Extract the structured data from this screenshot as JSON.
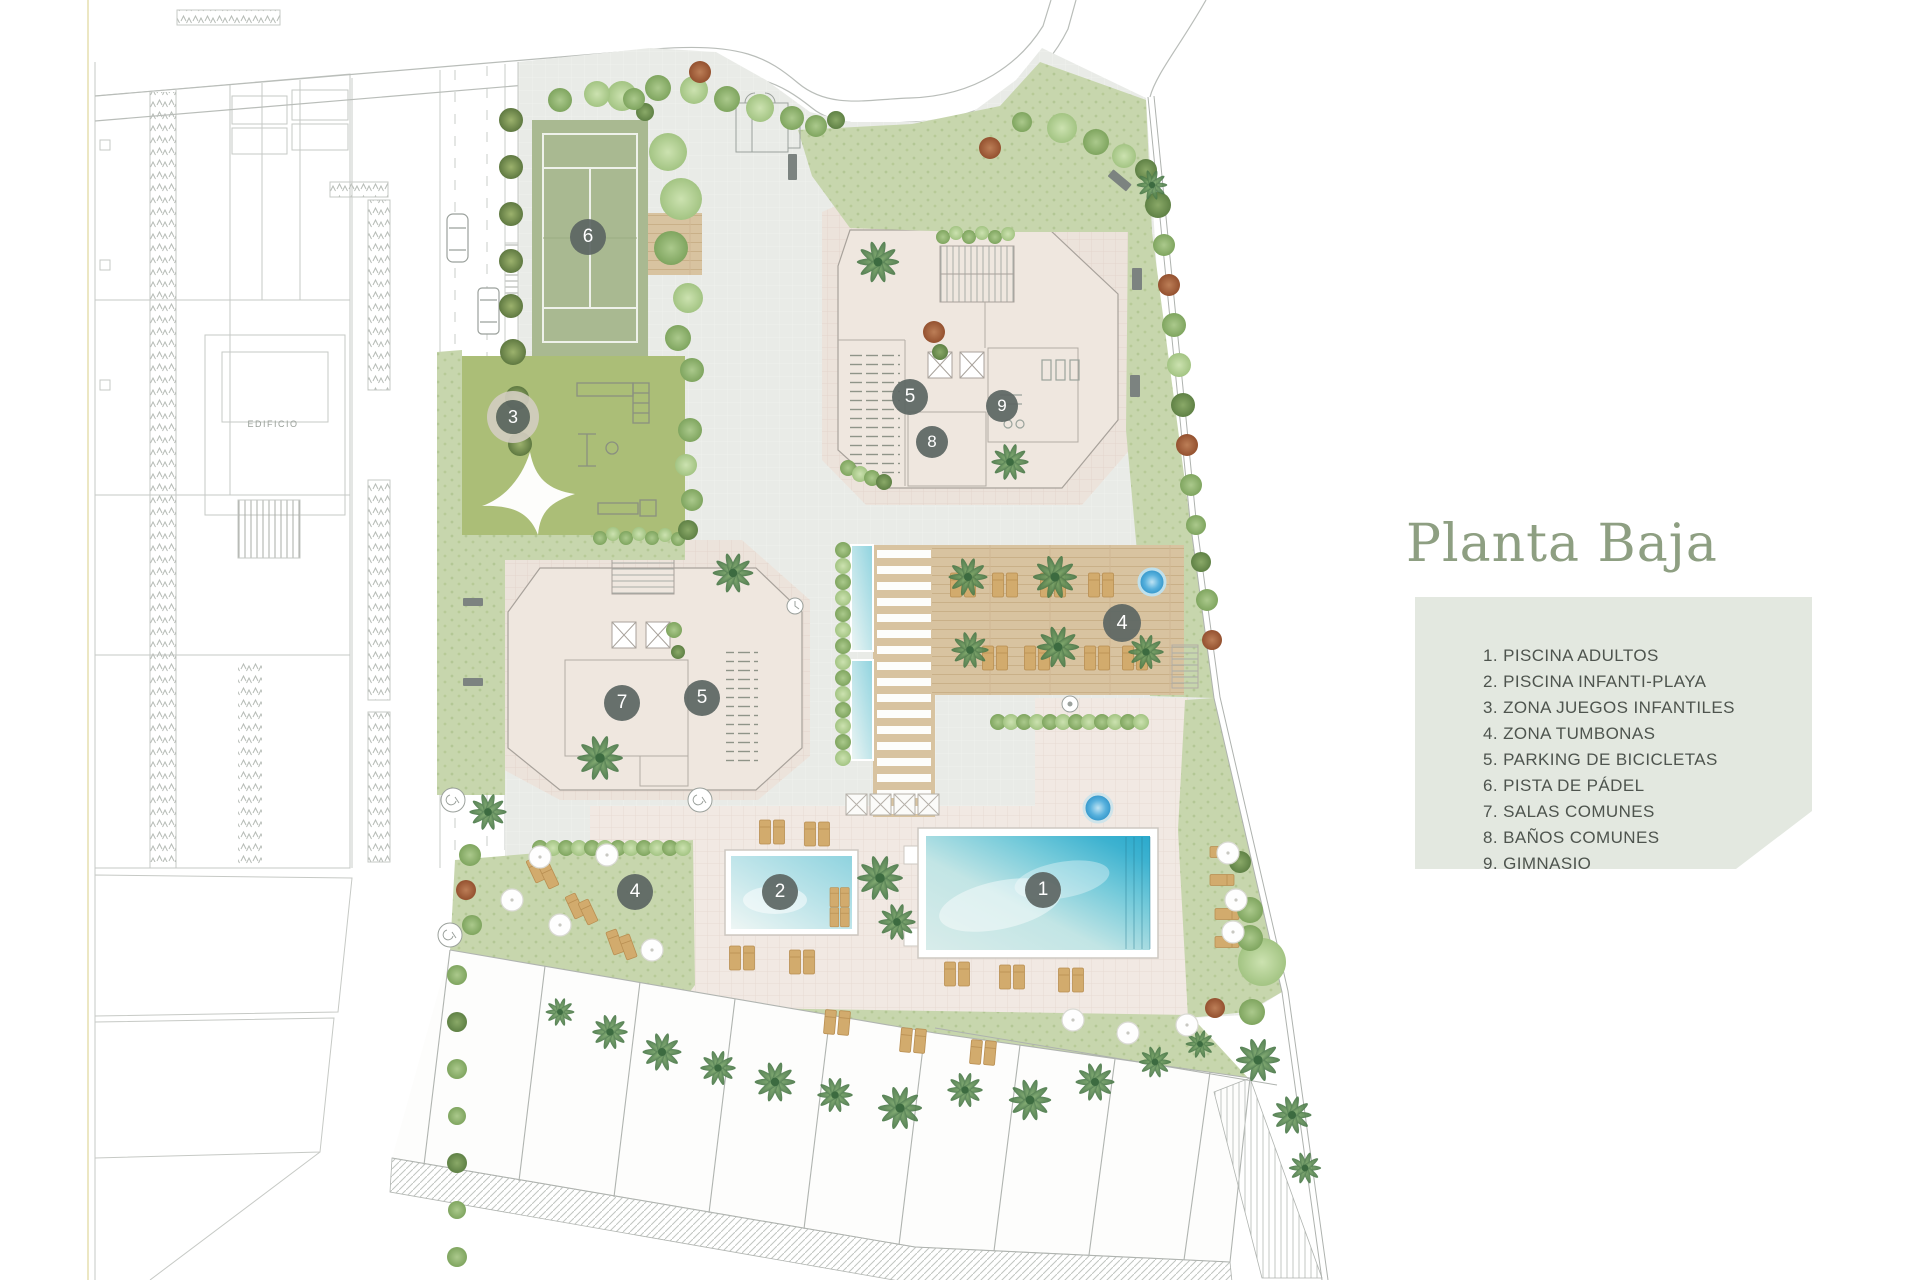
{
  "title": "Planta Baja",
  "legend": {
    "items": [
      "1. PISCINA ADULTOS",
      "2. PISCINA INFANTI-PLAYA",
      "3. ZONA JUEGOS INFANTILES",
      "4. ZONA TUMBONAS",
      "5. PARKING DE BICICLETAS",
      "6. PISTA DE PÁDEL",
      "7. SALAS COMUNES",
      "8. BAÑOS COMUNES",
      "9. GIMNASIO"
    ]
  },
  "plan": {
    "neighbor_building_label": "EDIFICIO",
    "markers": [
      {
        "n": "1",
        "x": 1043,
        "y": 890,
        "size": 36
      },
      {
        "n": "2",
        "x": 780,
        "y": 892,
        "size": 36
      },
      {
        "n": "3",
        "x": 513,
        "y": 417,
        "size": 34,
        "ring": true
      },
      {
        "n": "4",
        "x": 1122,
        "y": 623,
        "size": 38
      },
      {
        "n": "4",
        "x": 635,
        "y": 892,
        "size": 36
      },
      {
        "n": "5",
        "x": 910,
        "y": 397,
        "size": 36
      },
      {
        "n": "5",
        "x": 702,
        "y": 698,
        "size": 36
      },
      {
        "n": "6",
        "x": 588,
        "y": 237,
        "size": 36
      },
      {
        "n": "7",
        "x": 622,
        "y": 703,
        "size": 36
      },
      {
        "n": "8",
        "x": 932,
        "y": 442,
        "size": 32
      },
      {
        "n": "9",
        "x": 1002,
        "y": 406,
        "size": 32
      }
    ]
  },
  "colors": {
    "title": "#8e9f82",
    "legend_bg": "#e3e8e0",
    "legend_text": "#4e544e",
    "marker_bg": "#5d6663",
    "plaza": "#e9ebe7",
    "terrace": "#ece3db",
    "lawn": "#c7d6ad",
    "deck": "#d8c3a0",
    "padel": "#a9b991",
    "playground": "#abbe77",
    "water": "#2aa9cc"
  }
}
